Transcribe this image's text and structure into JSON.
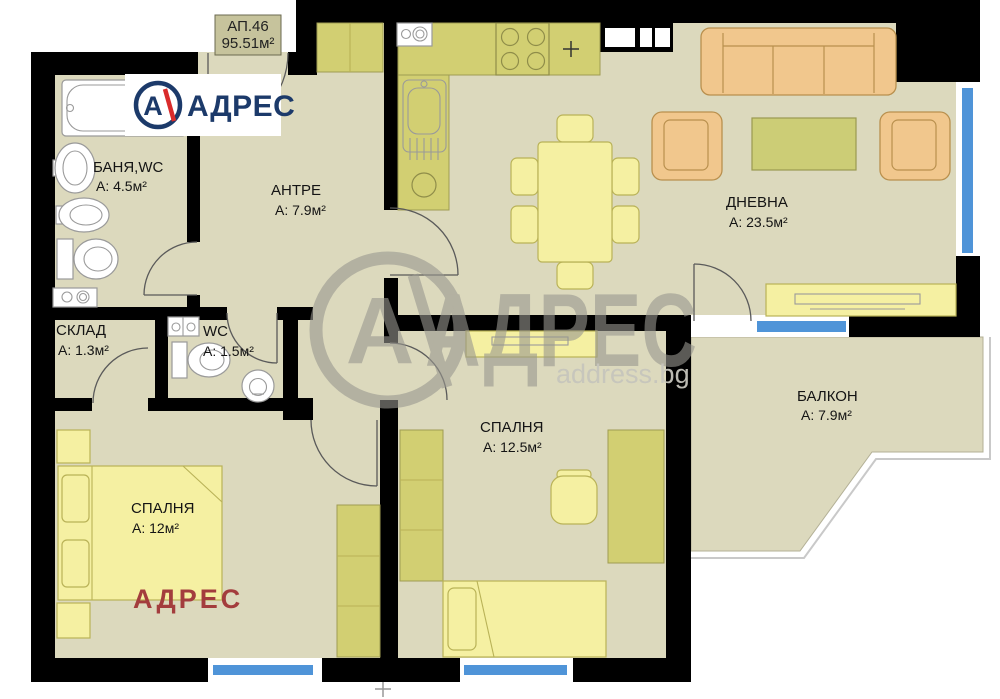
{
  "plan": {
    "unit": {
      "number": "АП.46",
      "area": "95.51м²"
    },
    "rooms": [
      {
        "id": "bathroom",
        "name": "БАНЯ,WC",
        "area": "А: 4.5м²"
      },
      {
        "id": "hallway",
        "name": "АНТРЕ",
        "area": "А: 7.9м²"
      },
      {
        "id": "storage",
        "name": "СКЛАД",
        "area": "А: 1.3м²"
      },
      {
        "id": "wc",
        "name": "WC",
        "area": "А: 1.5м²"
      },
      {
        "id": "living-room",
        "name": "ДНЕВНА",
        "area": "А: 23.5м²"
      },
      {
        "id": "bedroom-2",
        "name": "СПАЛНЯ",
        "area": "А: 12.5м²"
      },
      {
        "id": "balcony",
        "name": "БАЛКОН",
        "area": "А: 7.9м²"
      },
      {
        "id": "bedroom-1",
        "name": "СПАЛНЯ",
        "area": "А: 12м²"
      }
    ],
    "branding": {
      "logo_letter": "А",
      "logo_text": "АДРЕС",
      "watermark_letter": "А",
      "watermark_text": "АДРЕС",
      "watermark_domain": "address.bg",
      "stamp_text": "АДРЕС"
    },
    "colors": {
      "wall": "#000000",
      "floor": "#dcd9bd",
      "window_glass": "#4f94d8",
      "cabinet_olive": "#d2cf72",
      "furniture_yellow": "#f5f0a2",
      "sofa_orange": "#f1c78d",
      "logo_navy": "#1c3a6a",
      "logo_red": "#d92b2b",
      "stamp_red": "#a33d3d"
    }
  }
}
